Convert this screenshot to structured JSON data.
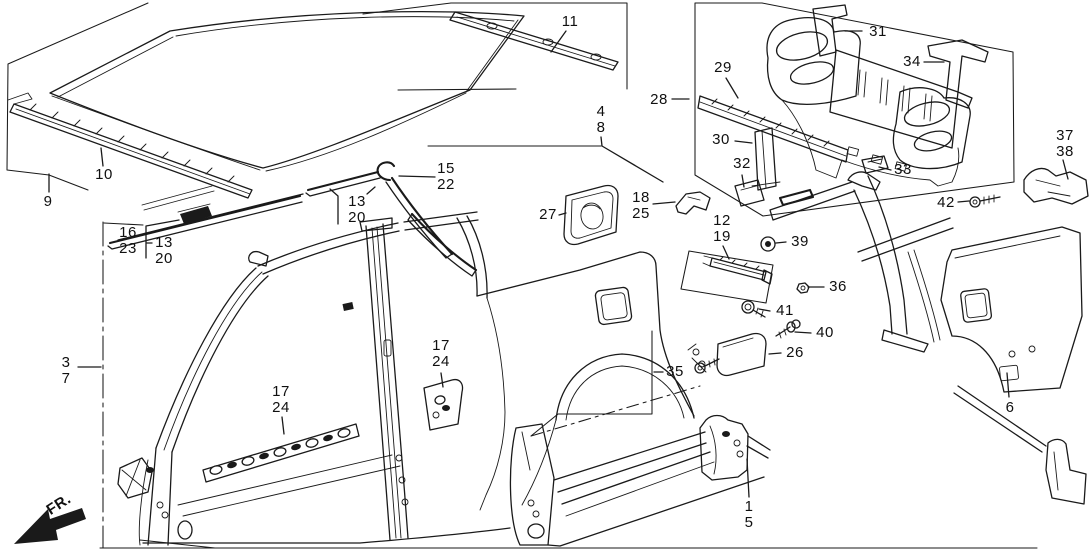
{
  "diagram": {
    "fr_label": "FR.",
    "background_color": "#ffffff",
    "line_color": "#1a1a1a",
    "callouts": [
      {
        "name": "part-9",
        "lines": [
          "9"
        ],
        "x": 48,
        "y": 202,
        "leaders": [
          [
            [
              49,
              192
            ],
            [
              49,
              174
            ]
          ]
        ]
      },
      {
        "name": "part-10",
        "lines": [
          "10"
        ],
        "x": 104,
        "y": 175,
        "leaders": [
          [
            [
              103,
              166
            ],
            [
              101,
              148
            ]
          ]
        ]
      },
      {
        "name": "part-11",
        "lines": [
          "11"
        ],
        "x": 570,
        "y": 22,
        "leaders": [
          [
            [
              566,
              31
            ],
            [
              551,
              52
            ]
          ]
        ]
      },
      {
        "name": "part-4-8",
        "lines": [
          "4",
          "8"
        ],
        "x": 601,
        "y": 120,
        "leaders": [
          [
            [
              601,
              137
            ],
            [
              602,
              146
            ],
            [
              663,
              182
            ]
          ]
        ]
      },
      {
        "name": "part-28",
        "lines": [
          "28"
        ],
        "x": 659,
        "y": 100,
        "leaders": [
          [
            [
              672,
              99
            ],
            [
              689,
              99
            ]
          ]
        ]
      },
      {
        "name": "part-29",
        "lines": [
          "29"
        ],
        "x": 723,
        "y": 68,
        "leaders": [
          [
            [
              726,
              78
            ],
            [
              738,
              98
            ]
          ]
        ]
      },
      {
        "name": "part-31",
        "lines": [
          "31"
        ],
        "x": 878,
        "y": 32,
        "leaders": [
          [
            [
              862,
              31
            ],
            [
              845,
              31
            ]
          ]
        ]
      },
      {
        "name": "part-34",
        "lines": [
          "34"
        ],
        "x": 912,
        "y": 62,
        "leaders": [
          [
            [
              924,
              62
            ],
            [
              944,
              62
            ]
          ]
        ]
      },
      {
        "name": "part-30",
        "lines": [
          "30"
        ],
        "x": 721,
        "y": 140,
        "leaders": [
          [
            [
              735,
              141
            ],
            [
              752,
              143
            ]
          ]
        ]
      },
      {
        "name": "part-32",
        "lines": [
          "32"
        ],
        "x": 742,
        "y": 164,
        "leaders": [
          [
            [
              742,
              175
            ],
            [
              744,
              187
            ]
          ]
        ]
      },
      {
        "name": "part-33",
        "lines": [
          "33"
        ],
        "x": 903,
        "y": 170,
        "leaders": [
          [
            [
              891,
              170
            ],
            [
              879,
              167
            ]
          ]
        ]
      },
      {
        "name": "part-37-38",
        "lines": [
          "37",
          "38"
        ],
        "x": 1065,
        "y": 144,
        "leaders": [
          [
            [
              1063,
              160
            ],
            [
              1068,
              179
            ]
          ]
        ]
      },
      {
        "name": "part-42",
        "lines": [
          "42"
        ],
        "x": 946,
        "y": 203,
        "leaders": [
          [
            [
              958,
              202
            ],
            [
              969,
              201
            ]
          ]
        ]
      },
      {
        "name": "part-12-19",
        "lines": [
          "12",
          "19"
        ],
        "x": 722,
        "y": 229,
        "leaders": [
          [
            [
              723,
              246
            ],
            [
              729,
              259
            ]
          ]
        ]
      },
      {
        "name": "part-18-25",
        "lines": [
          "18",
          "25"
        ],
        "x": 641,
        "y": 206,
        "leaders": [
          [
            [
              653,
              204
            ],
            [
              675,
              202
            ]
          ]
        ]
      },
      {
        "name": "part-27",
        "lines": [
          "27"
        ],
        "x": 548,
        "y": 215,
        "leaders": [
          [
            [
              559,
              215
            ],
            [
              566,
              213
            ]
          ]
        ]
      },
      {
        "name": "part-15-22",
        "lines": [
          "15",
          "22"
        ],
        "x": 446,
        "y": 177,
        "leaders": [
          [
            [
              435,
              177
            ],
            [
              399,
              176
            ]
          ]
        ]
      },
      {
        "name": "part-13-20-center",
        "lines": [
          "13",
          "20"
        ],
        "x": 357,
        "y": 210,
        "leaders": [
          [
            [
              338,
              224
            ],
            [
              338,
              196
            ],
            [
              330,
              189
            ]
          ],
          [
            [
              367,
              194
            ],
            [
              375,
              187
            ]
          ]
        ]
      },
      {
        "name": "part-16-23",
        "lines": [
          "16",
          "23"
        ],
        "x": 128,
        "y": 241,
        "leaders": [
          [
            [
              146,
              258
            ],
            [
              146,
              226
            ],
            [
              179,
              220
            ]
          ]
        ]
      },
      {
        "name": "part-13-20-left",
        "lines": [
          "13",
          "20"
        ],
        "x": 164,
        "y": 251,
        "leaders": [
          [
            [
              152,
              243
            ],
            [
              147,
              243
            ]
          ]
        ]
      },
      {
        "name": "part-3-7",
        "lines": [
          "3",
          "7"
        ],
        "x": 66,
        "y": 371,
        "leaders": [
          [
            [
              78,
              367
            ],
            [
              101,
              367
            ]
          ]
        ]
      },
      {
        "name": "part-17-24-a",
        "lines": [
          "17",
          "24"
        ],
        "x": 281,
        "y": 400,
        "leaders": [
          [
            [
              282,
              417
            ],
            [
              284,
              434
            ]
          ]
        ]
      },
      {
        "name": "part-17-24-b",
        "lines": [
          "17",
          "24"
        ],
        "x": 441,
        "y": 354,
        "leaders": [
          [
            [
              441,
              373
            ],
            [
              443,
              387
            ]
          ]
        ]
      },
      {
        "name": "part-35",
        "lines": [
          "35"
        ],
        "x": 675,
        "y": 372,
        "leaders": [
          [
            [
              663,
              372
            ],
            [
              654,
              372
            ]
          ]
        ]
      },
      {
        "name": "part-1-5",
        "lines": [
          "1",
          "5"
        ],
        "x": 749,
        "y": 515,
        "leaders": [
          [
            [
              749,
              497
            ],
            [
              747,
              459
            ]
          ]
        ]
      },
      {
        "name": "part-6",
        "lines": [
          "6"
        ],
        "x": 1010,
        "y": 408,
        "leaders": [
          [
            [
              1009,
              397
            ],
            [
              1007,
              373
            ]
          ]
        ]
      },
      {
        "name": "part-26",
        "lines": [
          "26"
        ],
        "x": 795,
        "y": 353,
        "leaders": [
          [
            [
              781,
              353
            ],
            [
              769,
              354
            ]
          ]
        ]
      },
      {
        "name": "part-36",
        "lines": [
          "36"
        ],
        "x": 838,
        "y": 287,
        "leaders": [
          [
            [
              824,
              287
            ],
            [
              808,
              287
            ]
          ]
        ]
      },
      {
        "name": "part-39",
        "lines": [
          "39"
        ],
        "x": 800,
        "y": 242,
        "leaders": [
          [
            [
              786,
              242
            ],
            [
              776,
              243
            ]
          ]
        ]
      },
      {
        "name": "part-40",
        "lines": [
          "40"
        ],
        "x": 825,
        "y": 333,
        "leaders": [
          [
            [
              811,
              333
            ],
            [
              795,
              332
            ]
          ]
        ]
      },
      {
        "name": "part-41",
        "lines": [
          "41"
        ],
        "x": 785,
        "y": 311,
        "leaders": [
          [
            [
              770,
              311
            ],
            [
              759,
              309
            ]
          ]
        ]
      }
    ]
  }
}
